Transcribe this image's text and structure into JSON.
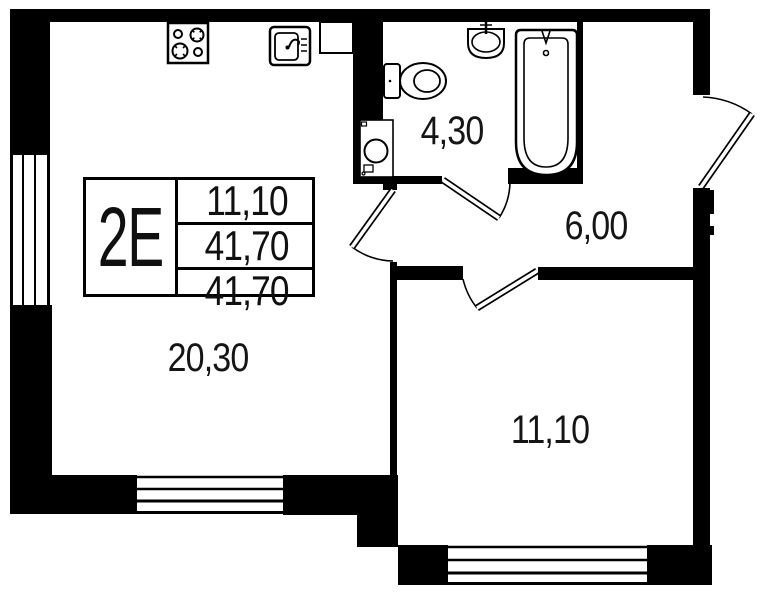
{
  "plan": {
    "unit_card": {
      "unit_label": "2E",
      "area_rows": [
        "11,10",
        "41,70",
        "41,70"
      ]
    },
    "rooms": [
      {
        "id": "living-kitchen",
        "area_label": "20,30"
      },
      {
        "id": "bathroom",
        "area_label": "4,30"
      },
      {
        "id": "hallway",
        "area_label": "6,00"
      },
      {
        "id": "bedroom",
        "area_label": "11,10"
      }
    ],
    "icons": [
      "stove-icon",
      "kitchen-sink-icon",
      "toilet-icon",
      "washbasin-icon",
      "bathtub-icon",
      "washing-machine-icon",
      "window-icon",
      "door-swing-icon"
    ],
    "colors": {
      "wall": "#000000",
      "background": "#ffffff",
      "text": "#101010"
    }
  }
}
